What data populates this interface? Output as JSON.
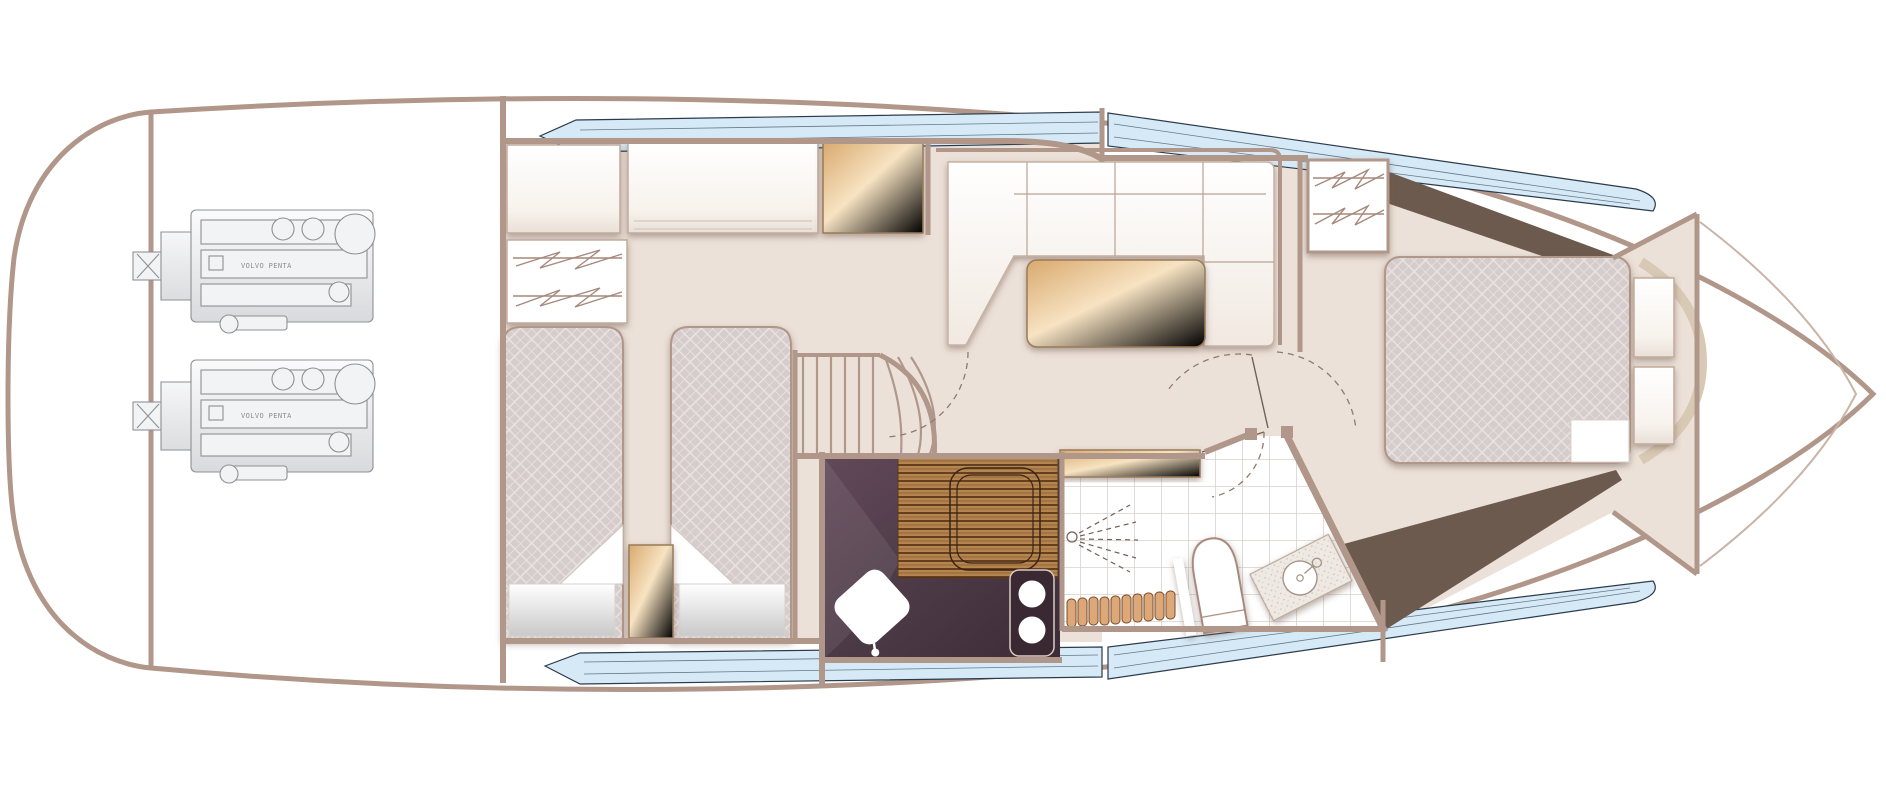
{
  "title": "Motor yacht lower deck floor plan",
  "colors": {
    "hull_outline": "#b1968a",
    "interior_wall": "#b1968a",
    "floor_beige": "#ece1d8",
    "deck_white": "#ffffff",
    "window_glass": "#d6e9f7",
    "window_outline": "#2c3b4a",
    "dark_bulkhead": "#6d5a4e",
    "bed_quilt": "#d5cccb",
    "cushion_white": "#faf6f1",
    "table_gold": "#e2b57e",
    "galley_counter_dark": "#4d3a47",
    "galley_wood_floor": "#b5854f",
    "step_wood": "#dca878",
    "tile_line": "#d8d2cc",
    "engine_line": "#8f9094"
  },
  "engines": {
    "count": 2,
    "label": "VOLVO PENTA"
  },
  "rooms": [
    {
      "id": "swim-platform",
      "name": "Swim platform / stern"
    },
    {
      "id": "engine-room",
      "name": "Engine room with twin engines"
    },
    {
      "id": "twin-cabin",
      "name": "Twin guest cabin with two berths and wardrobe"
    },
    {
      "id": "companionway",
      "name": "Companionway stairs"
    },
    {
      "id": "salon",
      "name": "Salon / dinette with U-sofa and table"
    },
    {
      "id": "galley",
      "name": "Galley with sink and two-burner hob"
    },
    {
      "id": "bathroom",
      "name": "Bathroom with shower, toilet and vanity"
    },
    {
      "id": "master-cabin",
      "name": "Forward master cabin with island bed"
    },
    {
      "id": "bow-locker",
      "name": "Bow chain locker"
    }
  ],
  "furniture": [
    "single-berth",
    "single-berth",
    "bedside-locker",
    "wardrobe-aft",
    "overhead-locker",
    "gold-cabinet",
    "u-sofa",
    "dinette-table",
    "wardrobe-forward",
    "galley-sink",
    "galley-hob",
    "galley-hatch",
    "vanity-counter",
    "toilet",
    "shower-head",
    "wooden-steps",
    "island-bed",
    "bedside-steps",
    "headboard"
  ]
}
